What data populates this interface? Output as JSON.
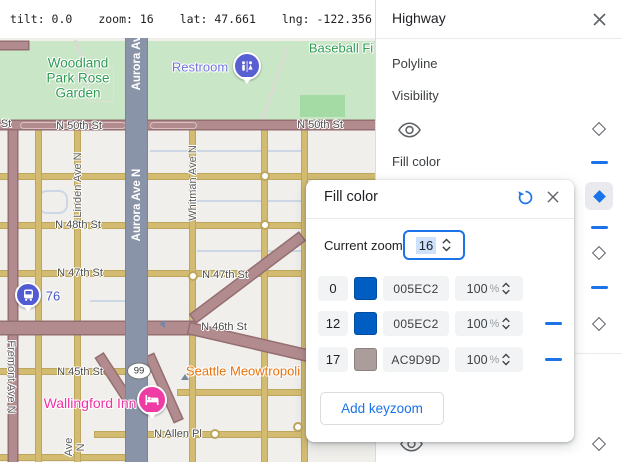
{
  "topbar": {
    "items": [
      "tilt: 0.0",
      "zoom: 16",
      "lat: 47.661",
      "lng: -122.356"
    ]
  },
  "panel": {
    "title": "Highway",
    "polyline_label": "Polyline",
    "visibility_label": "Visibility",
    "fill_color_label": "Fill color",
    "track": [
      {
        "y": 124,
        "type": "diamond"
      },
      {
        "y": 161,
        "type": "dash"
      },
      {
        "y": 182,
        "type": "diamond-selected"
      },
      {
        "y": 226,
        "type": "dash"
      },
      {
        "y": 248,
        "type": "diamond"
      },
      {
        "y": 286,
        "type": "dash"
      },
      {
        "y": 319,
        "type": "diamond"
      },
      {
        "y": 439,
        "type": "diamond"
      }
    ]
  },
  "popup": {
    "title": "Fill color",
    "current_zoom_label": "Current zoom",
    "current_zoom_value": "16",
    "rows": [
      {
        "zoom": "0",
        "swatch": "#005EC2",
        "hex": "005EC2",
        "opacity": "100",
        "percent_sign": "%",
        "removable": false
      },
      {
        "zoom": "12",
        "swatch": "#005EC2",
        "hex": "005EC2",
        "opacity": "100",
        "percent_sign": "%",
        "removable": true
      },
      {
        "zoom": "17",
        "swatch": "#AC9D9D",
        "hex": "AC9D9D",
        "opacity": "100",
        "percent_sign": "%",
        "removable": true
      }
    ],
    "add_button_label": "Add keyzoom"
  },
  "map": {
    "shield_99": "99",
    "labels": [
      {
        "text": "Woodland\nPark Rose\nGarden",
        "x": 78,
        "y": 40,
        "cls": "park-lbl"
      },
      {
        "text": "Restroom",
        "x": 200,
        "y": 29,
        "cls": "poi-blue"
      },
      {
        "text": "Baseball Fi",
        "x": 341,
        "y": 10,
        "cls": "park-sm"
      },
      {
        "text": "St",
        "x": 6,
        "y": 86,
        "cls": "street"
      },
      {
        "text": "N 50th St",
        "x": 79,
        "y": 88,
        "cls": "street"
      },
      {
        "text": "N 50th St",
        "x": 320,
        "y": 87,
        "cls": "street"
      },
      {
        "text": "Aurora Av",
        "x": 137,
        "y": 25,
        "cls": "vroute"
      },
      {
        "text": "Aurora Ave N",
        "x": 137,
        "y": 167,
        "cls": "vroute"
      },
      {
        "text": "Linden Ave N",
        "x": 78,
        "y": 147,
        "cls": "vstreet"
      },
      {
        "text": "Whitman Ave N",
        "x": 193,
        "y": 145,
        "cls": "vstreet"
      },
      {
        "text": "N 48th St",
        "x": 78,
        "y": 187,
        "cls": "street"
      },
      {
        "text": "N 47th St",
        "x": 80,
        "y": 235,
        "cls": "street"
      },
      {
        "text": "N 47th St",
        "x": 225,
        "y": 237,
        "cls": "street"
      },
      {
        "text": "76",
        "x": 53,
        "y": 258,
        "cls": "transit"
      },
      {
        "text": "N 46th St",
        "x": 224,
        "y": 289,
        "cls": "street"
      },
      {
        "text": "N 45th St",
        "x": 80,
        "y": 334,
        "cls": "street"
      },
      {
        "text": "Seattle Meowtropoli",
        "x": 243,
        "y": 333,
        "cls": "poi-orange"
      },
      {
        "text": "Wallingford Inn",
        "x": 90,
        "y": 365,
        "cls": "poi-pink"
      },
      {
        "text": "N Allen Pl",
        "x": 178,
        "y": 396,
        "cls": "street"
      },
      {
        "text": "Fremont Ave N",
        "x": 11,
        "y": 339,
        "cls": "vstreet-down"
      },
      {
        "text": "Ave N",
        "x": 75,
        "y": 409,
        "cls": "vstreet"
      }
    ]
  },
  "colors": {
    "accent_blue": "#1a73e8",
    "keyzoom_blue": "#005EC2",
    "keyzoom_taupe": "#AC9D9D",
    "road_major": "#b28b8e",
    "road_minor": "#d3bc72",
    "road_aurora": "#8a94a8",
    "park_green": "#c9e7c6"
  }
}
